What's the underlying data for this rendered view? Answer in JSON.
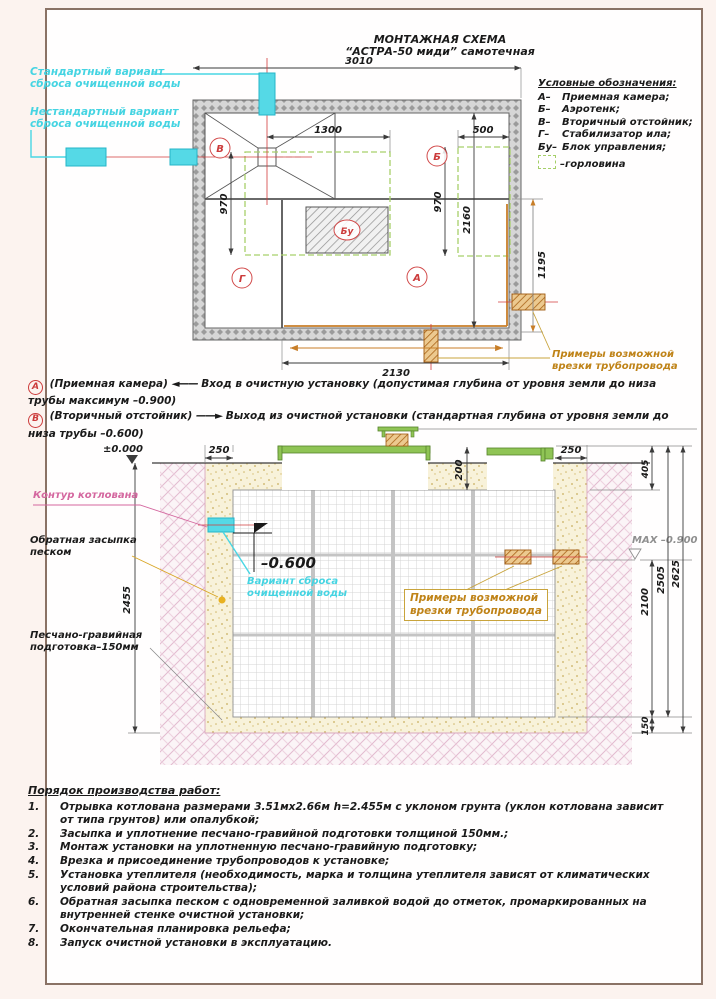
{
  "sheet": {
    "title1": "МОНТАЖНАЯ СХЕМА",
    "title2": "“АСТРА-50 миди” самотечная"
  },
  "legend": {
    "title": "Условные обозначения:",
    "items": [
      {
        "k": "А–",
        "v": "Приемная камера;"
      },
      {
        "k": "Б–",
        "v": "Аэротенк;"
      },
      {
        "k": "В–",
        "v": "Вторичный отстойник;"
      },
      {
        "k": "Г–",
        "v": "Стабилизатор ила;"
      },
      {
        "k": "Бу–",
        "v": "Блок управления;"
      }
    ],
    "gorlovina": "–горловина"
  },
  "plan": {
    "std1": "Стандартный вариант",
    "std2": "сброса очищенной воды",
    "nonstd1": "Нестандартный вариант",
    "nonstd2": "сброса очищенной воды",
    "d3010": "3010",
    "d1300": "1300",
    "d500": "500",
    "d970l": "970",
    "d970r": "970",
    "d2160": "2160",
    "d2130": "2130",
    "d1195": "1195",
    "cA": "А",
    "cB": "Б",
    "cV": "В",
    "cG": "Г",
    "cBu": "Бу",
    "primery1": "Примеры возможной",
    "primery2": "врезки трубопровода"
  },
  "notes": {
    "aKey": "А",
    "aTitle": "(Приемная камера)",
    "aArrow": "◄——",
    "aText": "Вход в очистную установку (допустимая глубина от уровня земли до низа трубы максимум –0.900)",
    "bKey": "В",
    "bTitle": "(Вторичный отстойник)",
    "bArrow": "——►",
    "bText": "Выход из очистной установки (стандартная глубина от уровня земли до низа трубы –0.600)"
  },
  "section": {
    "zero": "±0.000",
    "m600": "–0.600",
    "max": "MAX –0.900",
    "d250l": "250",
    "d250r": "250",
    "d200": "200",
    "d405": "405",
    "d2100": "2100",
    "d2505": "2505",
    "d2625": "2625",
    "d150": "150",
    "d2455": "2455",
    "kontur": "Контур котлована",
    "backfill1": "Обратная засыпка",
    "backfill2": "песком",
    "prep1": "Песчано-гравийная",
    "prep2": "подготовка–150мм",
    "variant1": "Вариант сброса",
    "variant2": "очищенной воды",
    "primery1": "Примеры возможной",
    "primery2": "врезки трубопровода"
  },
  "worklist": {
    "title": "Порядок производства работ:",
    "items": [
      {
        "num": "1.",
        "text": "Отрывка котлована размерами 3.51мх2.66м h=2.455м с уклоном грунта (уклон котлована зависит от типа грунтов) или опалубкой;"
      },
      {
        "num": "2.",
        "text": "Засыпка и уплотнение песчано-гравийной подготовки толщиной 150мм.;"
      },
      {
        "num": "3.",
        "text": "Монтаж установки на уплотненную песчано-гравийную подготовку;"
      },
      {
        "num": "4.",
        "text": "Врезка и присоединение трубопроводов к установке;"
      },
      {
        "num": "5.",
        "text": "Установка утеплителя (необходимость, марка и толщина утеплителя зависят от климатических условий района строительства);"
      },
      {
        "num": "6.",
        "text": "Обратная засыпка песком с одновременной заливкой водой до отметок, промаркированных на внутренней стенке очистной установки;"
      },
      {
        "num": "7.",
        "text": "Окончательная планировка рельефа;"
      },
      {
        "num": "8.",
        "text": "Запуск очистной установки в эксплуатацию."
      }
    ]
  }
}
